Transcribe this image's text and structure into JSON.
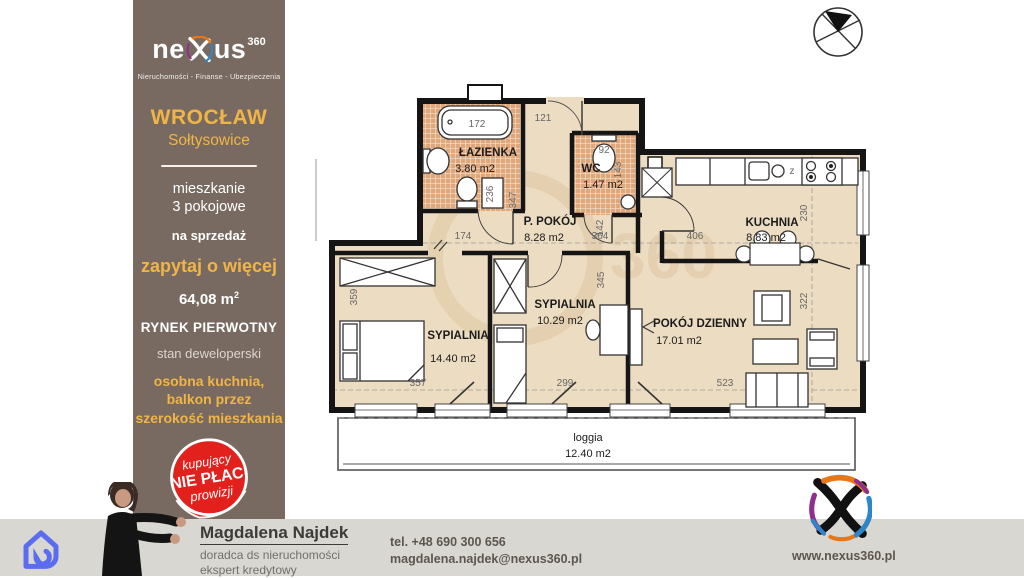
{
  "brand": {
    "logo_prefix": "ne",
    "logo_suffix": "us",
    "logo_sup": "360",
    "tagline": "Nieruchomości - Finanse - Ubezpieczenia",
    "website": "www.nexus360.pl",
    "accent_yellow": "#f0b546",
    "panel_brown": "#786a61",
    "badge_red": "#e2211c",
    "icon_blue": "#5b6cf0"
  },
  "listing": {
    "city": "WROCŁAW",
    "district": "Sołtysowice",
    "type_line1": "mieszkanie",
    "type_line2": "3 pokojowe",
    "offer": "na sprzedaż",
    "ask": "zapytaj o więcej",
    "area_value": "64,08 m",
    "area_sup": "2",
    "market": "RYNEK PIERWOTNY",
    "state": "stan deweloperski",
    "feature_line1": "osobna kuchnia,",
    "feature_line2": "balkon przez",
    "feature_line3": "szerokość mieszkania",
    "badge": {
      "line1": "kupujący",
      "line2": "NIE PŁACI",
      "line3": "prowizji"
    }
  },
  "agent": {
    "name": "Magdalena Najdek",
    "role1": "doradca ds nieruchomości",
    "role2": "ekspert kredytowy",
    "phone": "tel. +48 690 300 656",
    "email": "magdalena.najdek@nexus360.pl"
  },
  "floorplan": {
    "watermark": "360",
    "rooms": {
      "bathroom": {
        "name": "ŁAZIENKA",
        "area": "3.80 m2"
      },
      "wc": {
        "name": "WC",
        "area": "1.47 m2"
      },
      "hall": {
        "name": "P. POKÓJ",
        "area": "8.28 m2"
      },
      "kitchen": {
        "name": "KUCHNIA",
        "area": "8.83 m2"
      },
      "bedroom_small": {
        "name": "SYPIALNIA",
        "area": "10.29 m2"
      },
      "bedroom_large": {
        "name": "SYPIALNIA",
        "area": "14.40 m2"
      },
      "living": {
        "name": "POKÓJ DZIENNY",
        "area": "17.01 m2"
      },
      "loggia": {
        "name": "loggia",
        "area": "12.40 m2"
      }
    },
    "dims": {
      "d172": "172",
      "d121": "121",
      "d92": "92",
      "d143": "143",
      "d236": "236",
      "d347": "347",
      "d174": "174",
      "d364": "364",
      "d142": "142",
      "d406": "406",
      "d230": "230",
      "d322": "322",
      "d359": "359",
      "d357": "357",
      "d299": "299",
      "d345": "345",
      "d523": "523",
      "stove": "z"
    }
  }
}
